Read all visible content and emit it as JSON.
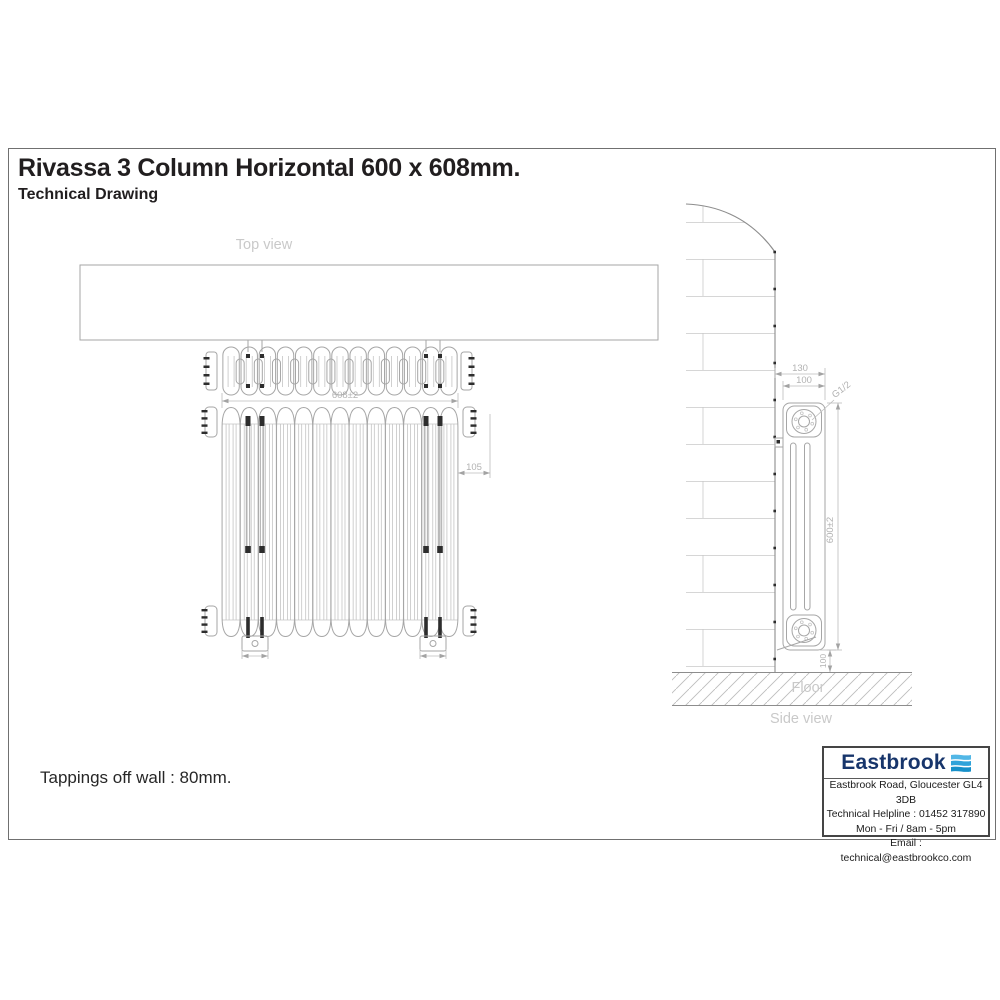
{
  "header": {
    "title": "Rivassa 3 Column Horizontal 600 x 608mm.",
    "subtitle": "Technical Drawing"
  },
  "labels": {
    "top_view": "Top view",
    "side_view": "Side view",
    "floor": "Floor"
  },
  "dimensions": {
    "width": "608±2",
    "height": "600±2",
    "depth": "100",
    "wall_to_front": "130",
    "thread": "G1/2",
    "end_offset": "105",
    "floor_clearance": "100"
  },
  "notes": {
    "tappings": "Tappings off wall : 80mm."
  },
  "drawing": {
    "sections": 13
  },
  "logo": {
    "brand": "Eastbrook",
    "address": "Eastbrook Road, Gloucester GL4 3DB",
    "helpline": "Technical Helpline : 01452 317890",
    "hours": "Mon - Fri / 8am - 5pm",
    "email": "Email : technical@eastbrookco.com"
  },
  "colors": {
    "line": "#a6a6a6",
    "dim_text": "#b2b2b2",
    "label_text": "#c9c9c9",
    "dark_marks": "#2d2d2d",
    "brand_navy": "#17356b",
    "brand_blue": "#35a3d9"
  }
}
